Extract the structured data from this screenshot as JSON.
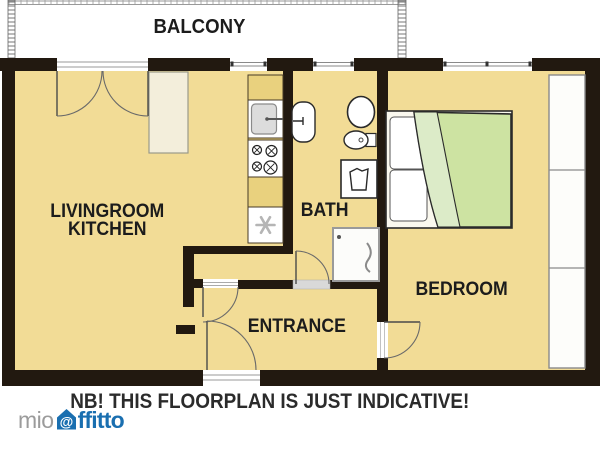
{
  "plan": {
    "rooms": {
      "balcony": "BALCONY",
      "livingroom_line1": "LIVINGROOM",
      "livingroom_line2": "KITCHEN",
      "bath": "BATH",
      "entrance": "ENTRANCE",
      "bedroom": "BEDROOM"
    },
    "caption": "NB! THIS FLOORPLAN IS JUST INDICATIVE!"
  },
  "logo": {
    "prefix": "mio",
    "at": "@",
    "suffix": "ffitto"
  },
  "colors": {
    "floor": "#f2dc96",
    "wall": "#221910",
    "counter": "#e9d17e",
    "cabinet": "#f3eedb",
    "bed_duvet": "#cde3a2",
    "bed_flap": "#dcebc8",
    "logo_gray": "#9b9b9b",
    "logo_blue": "#1a6fb0",
    "label_text": "#1c1c1c"
  }
}
